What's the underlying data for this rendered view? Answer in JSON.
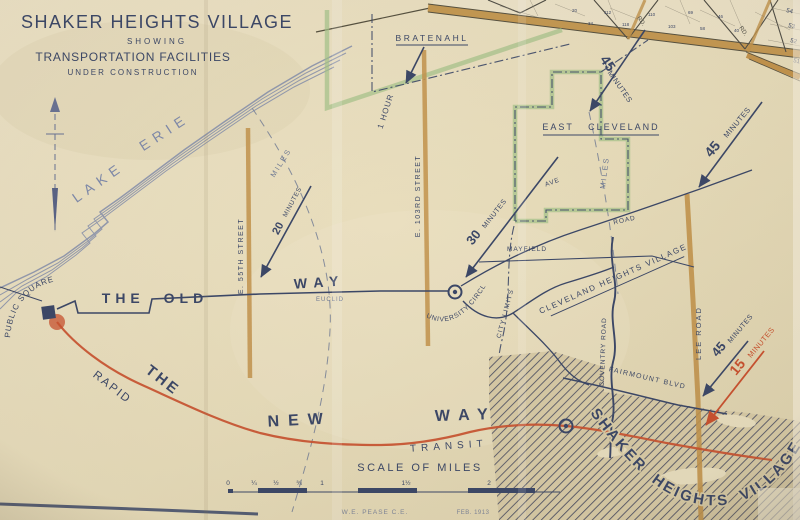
{
  "colors": {
    "paper": "#e8debf",
    "paper-deep": "#d9cca7",
    "ink": "#3b4767",
    "ink-soft": "#6d7894",
    "lake": "#7e89aa",
    "tan": "#c2934c",
    "tan-edge": "#55503f",
    "green": "#a4c289",
    "red": "#c9512f",
    "hatch": "#4c4f62",
    "grid": "#55534a"
  },
  "title": {
    "main": "SHAKER HEIGHTS VILLAGE",
    "sub1": "SHOWING",
    "sub2": "TRANSPORTATION FACILITIES",
    "sub3": "UNDER CONSTRUCTION"
  },
  "lake": {
    "word1": "LAKE",
    "word2": "ERIE"
  },
  "places": {
    "bratenahl": "BRATENAHL",
    "east_cleveland": "EAST CLEVELAND",
    "cleveland_heights_village": "CLEVELAND HEIGHTS VILLAGE",
    "shaker_heights_village": "SHAKER HEIGHTS VILLAGE",
    "public_square": "PUBLIC SQUARE",
    "university_circle": "UNIVERSITY CIRCLE"
  },
  "streets": {
    "e_55th": "E. 55TH STREET",
    "e_103rd": "E. 103RD STREET",
    "lee_road": "LEE ROAD",
    "coventry_road": "COVENTRY ROAD",
    "fairmount_blvd": "FAIRMOUNT BLVD",
    "mayfield": "MAYFIELD",
    "euclid": "EUCLID",
    "ave": "AVE",
    "road": "ROAD",
    "city_limits": "CITY LIMITS"
  },
  "routes": {
    "old_way_prefix": "THE OLD",
    "old_way_suffix": "WAY",
    "rapid_the": "THE",
    "rapid": "RAPID",
    "new_way_new": "NEW",
    "new_way_way": "WAY",
    "transit": "TRANSIT"
  },
  "travel_times": {
    "min45": "45",
    "min30": "30",
    "min20": "20",
    "min15": "15",
    "minutes": "MINUTES",
    "one_hour": "1 HOUR",
    "miles": "MILES"
  },
  "scale": {
    "title": "SCALE OF MILES",
    "ticks": [
      "0",
      "¼",
      "½",
      "¾",
      "1",
      "1½",
      "2"
    ]
  },
  "credit": {
    "engineer": "W.E. PEASE C.E.",
    "date": "FEB. 1913"
  },
  "plat": {
    "rd_abbr": "RD.",
    "edge_numbers": [
      "54",
      "53",
      "52",
      "51"
    ],
    "lot_numbers": [
      "112",
      "118",
      "110",
      "103",
      "69",
      "58",
      "46",
      "40",
      "34",
      "20"
    ]
  }
}
